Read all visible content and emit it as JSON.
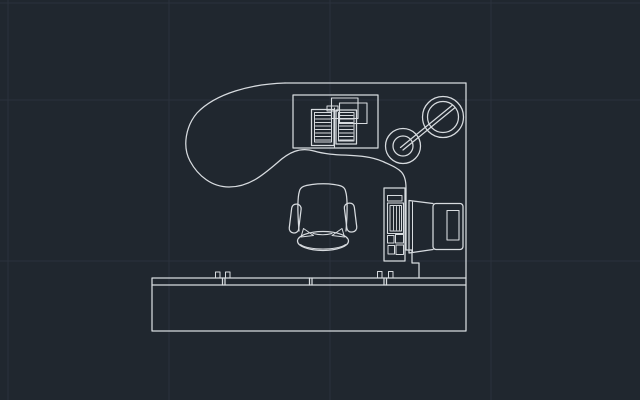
{
  "app": {
    "description": "CAD model-space viewport showing an office workstation plan: curved kidney desk, task chair, CPU tower, CRT monitor, desk lamp, open document tray and a credenza/worktop along the bottom wall"
  },
  "drawing": {
    "viewbox": "0 0 640 400",
    "background": "#20272f",
    "stroke": "#d7dbdf",
    "stroke_width": 1.25,
    "grid": {
      "color": "#2a323c",
      "width": 1,
      "vertical_x": [
        8,
        169,
        330,
        491
      ],
      "horizontal_y": [
        3,
        100,
        261
      ]
    },
    "entities": [
      {
        "name": "desk-back-edges",
        "shapes": [
          {
            "t": "l",
            "x1": 285,
            "y1": 83,
            "x2": 466,
            "y2": 83
          },
          {
            "t": "l",
            "x1": 466,
            "y1": 83,
            "x2": 466,
            "y2": 278
          }
        ]
      },
      {
        "name": "desk-front-curve",
        "shapes": [
          {
            "t": "p",
            "d": "M 285,83 C 252,84 216,93 197,113 C 186,126 182,146 190,161 C 198,176 212,187 229,187 C 249,187 263,175 277,163 C 289,152 300,147 314,151 C 338,158 362,152 384,162 C 399,169 406,171 406,188 L 406,250 L 412,250 L 412,263 L 419,263 L 419,278"
          }
        ]
      },
      {
        "name": "credenza",
        "shapes": [
          {
            "t": "r",
            "x": 152,
            "y": 278,
            "w": 314,
            "h": 53
          },
          {
            "t": "l",
            "x1": 152,
            "y1": 285,
            "x2": 466,
            "y2": 285
          },
          {
            "t": "l",
            "x1": 222.5,
            "y1": 278,
            "x2": 222.5,
            "y2": 285
          },
          {
            "t": "l",
            "x1": 225,
            "y1": 278,
            "x2": 225,
            "y2": 285
          },
          {
            "t": "l",
            "x1": 309.5,
            "y1": 278,
            "x2": 309.5,
            "y2": 285
          },
          {
            "t": "l",
            "x1": 312,
            "y1": 278,
            "x2": 312,
            "y2": 285
          },
          {
            "t": "l",
            "x1": 384,
            "y1": 278,
            "x2": 384,
            "y2": 285
          },
          {
            "t": "l",
            "x1": 386.5,
            "y1": 278,
            "x2": 386.5,
            "y2": 285
          },
          {
            "t": "r",
            "x": 215.5,
            "y": 272,
            "w": 4.5,
            "h": 6,
            "sw": 1
          },
          {
            "t": "r",
            "x": 225.5,
            "y": 272,
            "w": 4.5,
            "h": 6,
            "sw": 1
          },
          {
            "t": "r",
            "x": 377.5,
            "y": 271.5,
            "w": 4.5,
            "h": 6.5,
            "sw": 1
          },
          {
            "t": "r",
            "x": 388.5,
            "y": 271.5,
            "w": 4.5,
            "h": 6.5,
            "sw": 1
          }
        ]
      },
      {
        "name": "document-tray",
        "shapes": [
          {
            "t": "r",
            "x": 293,
            "y": 95,
            "w": 85,
            "h": 53
          },
          {
            "t": "r",
            "x": 331.5,
            "y": 98,
            "w": 26.5,
            "h": 20.5,
            "sw": 1.1
          },
          {
            "t": "r",
            "x": 339.5,
            "y": 103,
            "w": 27.5,
            "h": 20.5,
            "sw": 1.1
          },
          {
            "t": "r",
            "x": 327,
            "y": 106,
            "w": 11,
            "h": 5,
            "sw": 1
          },
          {
            "t": "r",
            "x": 311.5,
            "y": 109.5,
            "w": 22.5,
            "h": 36
          },
          {
            "t": "r",
            "x": 314.5,
            "y": 112.5,
            "w": 17,
            "h": 29.5,
            "sw": 1
          },
          {
            "t": "r",
            "x": 336,
            "y": 110,
            "w": 20.5,
            "h": 34
          },
          {
            "t": "r",
            "x": 338.5,
            "y": 112.5,
            "w": 15.5,
            "h": 28.5,
            "sw": 1
          },
          {
            "t": "l",
            "x1": 334.5,
            "y1": 108,
            "x2": 334.5,
            "y2": 147,
            "sw": 1.1
          },
          {
            "t": "l",
            "x1": 315.5,
            "y1": 115.5,
            "x2": 330.5,
            "y2": 115.5,
            "sw": 0.9
          },
          {
            "t": "l",
            "x1": 315.5,
            "y1": 119,
            "x2": 330.5,
            "y2": 119,
            "sw": 0.9
          },
          {
            "t": "l",
            "x1": 315.5,
            "y1": 122.5,
            "x2": 330.5,
            "y2": 122.5,
            "sw": 0.9
          },
          {
            "t": "l",
            "x1": 315.5,
            "y1": 126,
            "x2": 330.5,
            "y2": 126,
            "sw": 0.9
          },
          {
            "t": "l",
            "x1": 315.5,
            "y1": 129.5,
            "x2": 330.5,
            "y2": 129.5,
            "sw": 0.9
          },
          {
            "t": "l",
            "x1": 315.5,
            "y1": 133,
            "x2": 330.5,
            "y2": 133,
            "sw": 0.9
          },
          {
            "t": "l",
            "x1": 315.5,
            "y1": 136.5,
            "x2": 330.5,
            "y2": 136.5,
            "sw": 0.9
          },
          {
            "t": "l",
            "x1": 315.5,
            "y1": 140,
            "x2": 330.5,
            "y2": 140,
            "sw": 0.9
          },
          {
            "t": "l",
            "x1": 339.5,
            "y1": 115.5,
            "x2": 353,
            "y2": 115.5,
            "sw": 0.9
          },
          {
            "t": "l",
            "x1": 339.5,
            "y1": 119,
            "x2": 353,
            "y2": 119,
            "sw": 0.9
          },
          {
            "t": "l",
            "x1": 339.5,
            "y1": 122.5,
            "x2": 353,
            "y2": 122.5,
            "sw": 0.9
          },
          {
            "t": "l",
            "x1": 339.5,
            "y1": 126,
            "x2": 353,
            "y2": 126,
            "sw": 0.9
          },
          {
            "t": "l",
            "x1": 339.5,
            "y1": 129.5,
            "x2": 353,
            "y2": 129.5,
            "sw": 0.9
          },
          {
            "t": "l",
            "x1": 339.5,
            "y1": 133,
            "x2": 353,
            "y2": 133,
            "sw": 0.9
          },
          {
            "t": "l",
            "x1": 339.5,
            "y1": 136.5,
            "x2": 353,
            "y2": 136.5,
            "sw": 0.9
          },
          {
            "t": "l",
            "x1": 339.5,
            "y1": 140,
            "x2": 353,
            "y2": 140,
            "sw": 0.9
          }
        ]
      },
      {
        "name": "desk-lamp",
        "shapes": [
          {
            "t": "c",
            "cx": 443,
            "cy": 117,
            "r": 20.5
          },
          {
            "t": "c",
            "cx": 443,
            "cy": 117,
            "r": 15.5
          },
          {
            "t": "c",
            "cx": 403,
            "cy": 146,
            "r": 17.5
          },
          {
            "t": "c",
            "cx": 403,
            "cy": 146,
            "r": 10
          },
          {
            "t": "l",
            "x1": 400.5,
            "y1": 147.5,
            "x2": 452,
            "y2": 105.5
          },
          {
            "t": "l",
            "x1": 403,
            "y1": 150,
            "x2": 454.5,
            "y2": 108
          }
        ]
      },
      {
        "name": "office-chair",
        "shapes": [
          {
            "t": "p",
            "d": "M 299,231 C 297.5,212 297.5,197 299.5,191 C 300.5,186.5 305,185.5 312,184.5 C 320,183.5 327,183.5 334,184.5 C 341,185.5 344.5,186.5 345.5,191 C 347.5,197 347.5,212 346,231"
          },
          {
            "t": "p",
            "d": "M 313,233.5 Q 323,236 332,233.5",
            "sw": 1
          },
          {
            "t": "p",
            "d": "M 301,237 L 303.5,228.5 L 313.5,235.5 Z",
            "sw": 1
          },
          {
            "t": "p",
            "d": "M 344.5,237 L 342,228.5 L 332,235.5 Z",
            "sw": 1
          },
          {
            "t": "r",
            "x": 290.5,
            "y": 204,
            "w": 9.5,
            "h": 29,
            "rx": 4.5,
            "rot": [
              7,
              295,
              218
            ]
          },
          {
            "t": "r",
            "x": 345.5,
            "y": 203,
            "w": 10,
            "h": 29,
            "rx": 4.5,
            "rot": [
              -7,
              351,
              217
            ]
          },
          {
            "t": "e",
            "cx": 323,
            "cy": 241,
            "rx": 25.5,
            "ry": 9.5
          },
          {
            "t": "p",
            "d": "M 300.5,244.5 C 308,250.5 338,250.5 345.5,244.5",
            "sw": 1
          }
        ]
      },
      {
        "name": "cpu-tower",
        "shapes": [
          {
            "t": "r",
            "x": 384,
            "y": 188,
            "w": 21,
            "h": 73
          },
          {
            "t": "r",
            "x": 387.5,
            "y": 195.5,
            "w": 14.5,
            "h": 5.5,
            "sw": 1
          },
          {
            "t": "r",
            "x": 387.5,
            "y": 203,
            "w": 16,
            "h": 30.5,
            "sw": 1.1
          },
          {
            "t": "r",
            "x": 390,
            "y": 205.5,
            "w": 11.5,
            "h": 25.5,
            "sw": 1
          },
          {
            "t": "l",
            "x1": 393.5,
            "y1": 206.5,
            "x2": 393.5,
            "y2": 230,
            "sw": 0.9
          },
          {
            "t": "l",
            "x1": 396.5,
            "y1": 206.5,
            "x2": 396.5,
            "y2": 230,
            "sw": 0.9
          },
          {
            "t": "l",
            "x1": 399.5,
            "y1": 206.5,
            "x2": 399.5,
            "y2": 230,
            "sw": 0.9
          },
          {
            "t": "r",
            "x": 387.5,
            "y": 235.5,
            "w": 6.5,
            "h": 7.5,
            "sw": 1
          },
          {
            "t": "r",
            "x": 395.5,
            "y": 234.5,
            "w": 8,
            "h": 8.5,
            "sw": 1
          },
          {
            "t": "r",
            "x": 388,
            "y": 245.5,
            "w": 6.5,
            "h": 8.5,
            "sw": 1
          },
          {
            "t": "r",
            "x": 396,
            "y": 245,
            "w": 7.5,
            "h": 9.5,
            "sw": 1
          }
        ]
      },
      {
        "name": "monitor",
        "shapes": [
          {
            "t": "p",
            "d": "M 433,203.5 L 409,200.5 L 409,253 L 433,249.5"
          },
          {
            "t": "l",
            "x1": 412.5,
            "y1": 202,
            "x2": 412.5,
            "y2": 251.5,
            "sw": 1
          },
          {
            "t": "r",
            "x": 433,
            "y": 203.5,
            "w": 30,
            "h": 46,
            "rx": 3
          },
          {
            "t": "r",
            "x": 447,
            "y": 210.5,
            "w": 12,
            "h": 29.5,
            "sw": 1.1
          }
        ]
      }
    ]
  }
}
